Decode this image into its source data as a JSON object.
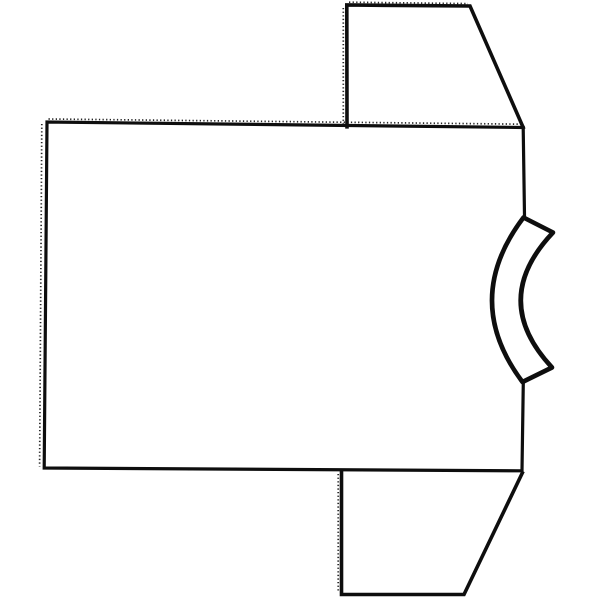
{
  "meta": {
    "title": "T-shirt outline drawing",
    "description": "Black-and-white hand-drawn outline of a short-sleeve T-shirt lying on its side (rotated 90 degrees), with the curved collar band on the right edge, one sleeve at the top right and one sleeve at the bottom right; serrated stitch-mark texture along the top and left edges",
    "background_color": "#ffffff",
    "ink_color": "#0e0e0e"
  },
  "canvas": {
    "width": 600,
    "height": 600,
    "view_box": "0 0 600 600"
  },
  "shapes": {
    "body": {
      "label": "shirt body (large rectangle)",
      "d": "M 524.5 215.5 L 523.2 127.5 L 47 122 L 44.2 468 L 522 470.8 L 523.3 382"
    },
    "top_sleeve": {
      "label": "upper sleeve trapezoid",
      "d": "M 347 126.8 L 346.8 5 L 470 6 L 523.2 127.5"
    },
    "bottom_sleeve": {
      "label": "lower sleeve trapezoid",
      "d": "M 341.5 471 L 341.5 594.5 L 464 594.5 L 522.3 473"
    },
    "collar_band": {
      "label": "curved neckline collar band",
      "d": "M 553 232.5 L 523.5 217.5 Q 461 300 522.5 382 L 552 367.5 Q 489 300 553 232.5 Z"
    },
    "stitch_top_edge": {
      "label": "stitch marks above top edge",
      "d": "M 48.5 119 L 523 124.2"
    },
    "stitch_left_edge": {
      "label": "stitch marks left of left edge",
      "d": "M 41.8 124 L 39.6 466.5"
    },
    "stitch_top_sleeve_left": {
      "label": "stitch marks left of upper sleeve edge",
      "d": "M 343.3 8 L 343.3 124"
    },
    "stitch_top_sleeve_top": {
      "label": "stitch marks above upper sleeve top edge",
      "d": "M 349 2.2 L 468 3.6"
    },
    "stitch_bottom_sleeve_left": {
      "label": "stitch marks left of lower sleeve edge",
      "d": "M 338.2 474 L 338.2 592"
    }
  }
}
